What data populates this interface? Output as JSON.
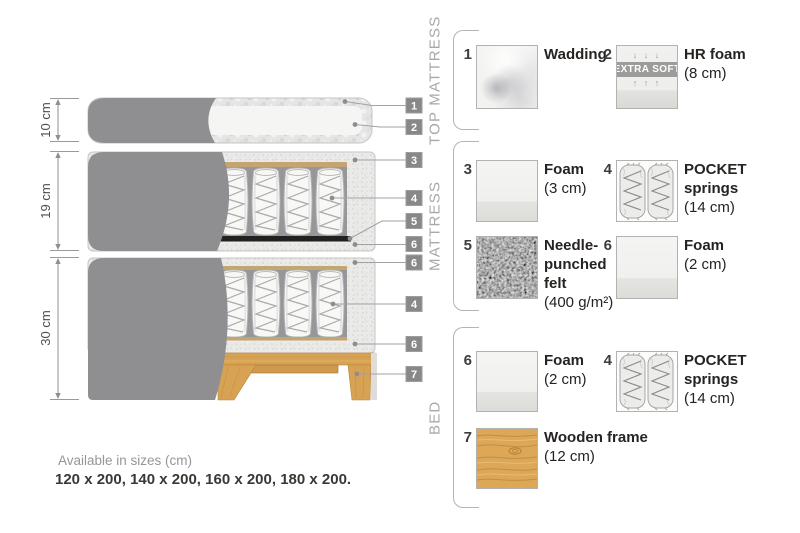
{
  "diagram": {
    "dimensions": [
      {
        "label": "10 cm"
      },
      {
        "label": "19 cm"
      },
      {
        "label": "30 cm"
      }
    ],
    "callouts": [
      "1",
      "2",
      "3",
      "4",
      "5",
      "6",
      "6",
      "4",
      "6",
      "7"
    ]
  },
  "legend": {
    "sections": [
      {
        "label": "TOP MATTRESS",
        "items": [
          {
            "num": "1",
            "title": "Wadding",
            "size": ""
          },
          {
            "num": "2",
            "title": "HR foam",
            "size": "(8 cm)",
            "badge": "EXTRA SOFT",
            "arrows_down": "↓ ↓ ↓",
            "arrows_up": "↑ ↑ ↑"
          }
        ]
      },
      {
        "label": "MATTRESS",
        "items": [
          {
            "num": "3",
            "title": "Foam",
            "size": "(3 cm)"
          },
          {
            "num": "4",
            "title": "POCKET springs",
            "size": "(14 cm)"
          },
          {
            "num": "5",
            "title": "Needle-punched felt",
            "size": "(400 g/m²)"
          },
          {
            "num": "6",
            "title": "Foam",
            "size": "(2 cm)"
          }
        ]
      },
      {
        "label": "BED",
        "items": [
          {
            "num": "6",
            "title": "Foam",
            "size": "(2 cm)"
          },
          {
            "num": "4",
            "title": "POCKET springs",
            "size": "(14 cm)"
          },
          {
            "num": "7",
            "title": "Wooden frame",
            "size": "(12 cm)"
          }
        ]
      }
    ]
  },
  "footer": {
    "line1": "Available in sizes (cm)",
    "line2": "120 x 200, 140 x 200, 160 x 200, 180 x 200."
  },
  "colors": {
    "fabric_gray": "#8f8f91",
    "foam_speckle": "#e9e9e7",
    "spring_cavity": "#97979b",
    "felt_black": "#212121",
    "wood": "#d8a254",
    "tag_gray": "#88888a",
    "badge_gray": "#9c9c9a",
    "text_dark": "#262321",
    "text_muted": "#969696"
  }
}
